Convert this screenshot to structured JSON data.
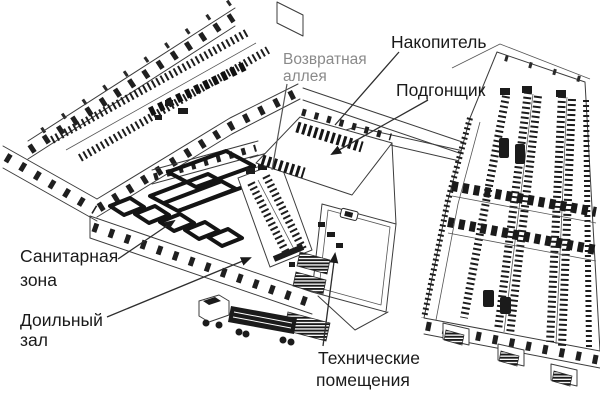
{
  "figure": {
    "background_color": "#ffffff",
    "line_color": "#3c3c3c",
    "dark_fill": "#1b1b1b"
  },
  "labels": {
    "return_alley": {
      "line1": "Возвратная",
      "line2": "аллея",
      "color": "#8a8a8a"
    },
    "holding_area": {
      "text": "Накопитель",
      "color": "#1a1a1a"
    },
    "crowd_gate": {
      "text": "Подгонщик",
      "color": "#1a1a1a"
    },
    "sanitary_zone": {
      "line1": "Санитарная",
      "line2": "зона",
      "color": "#1a1a1a"
    },
    "milking_parlor": {
      "line1": "Доильный",
      "line2": "зал",
      "color": "#1a1a1a"
    },
    "technical_rooms": {
      "line1": "Технические",
      "line2": "помещения",
      "color": "#1a1a1a"
    }
  }
}
